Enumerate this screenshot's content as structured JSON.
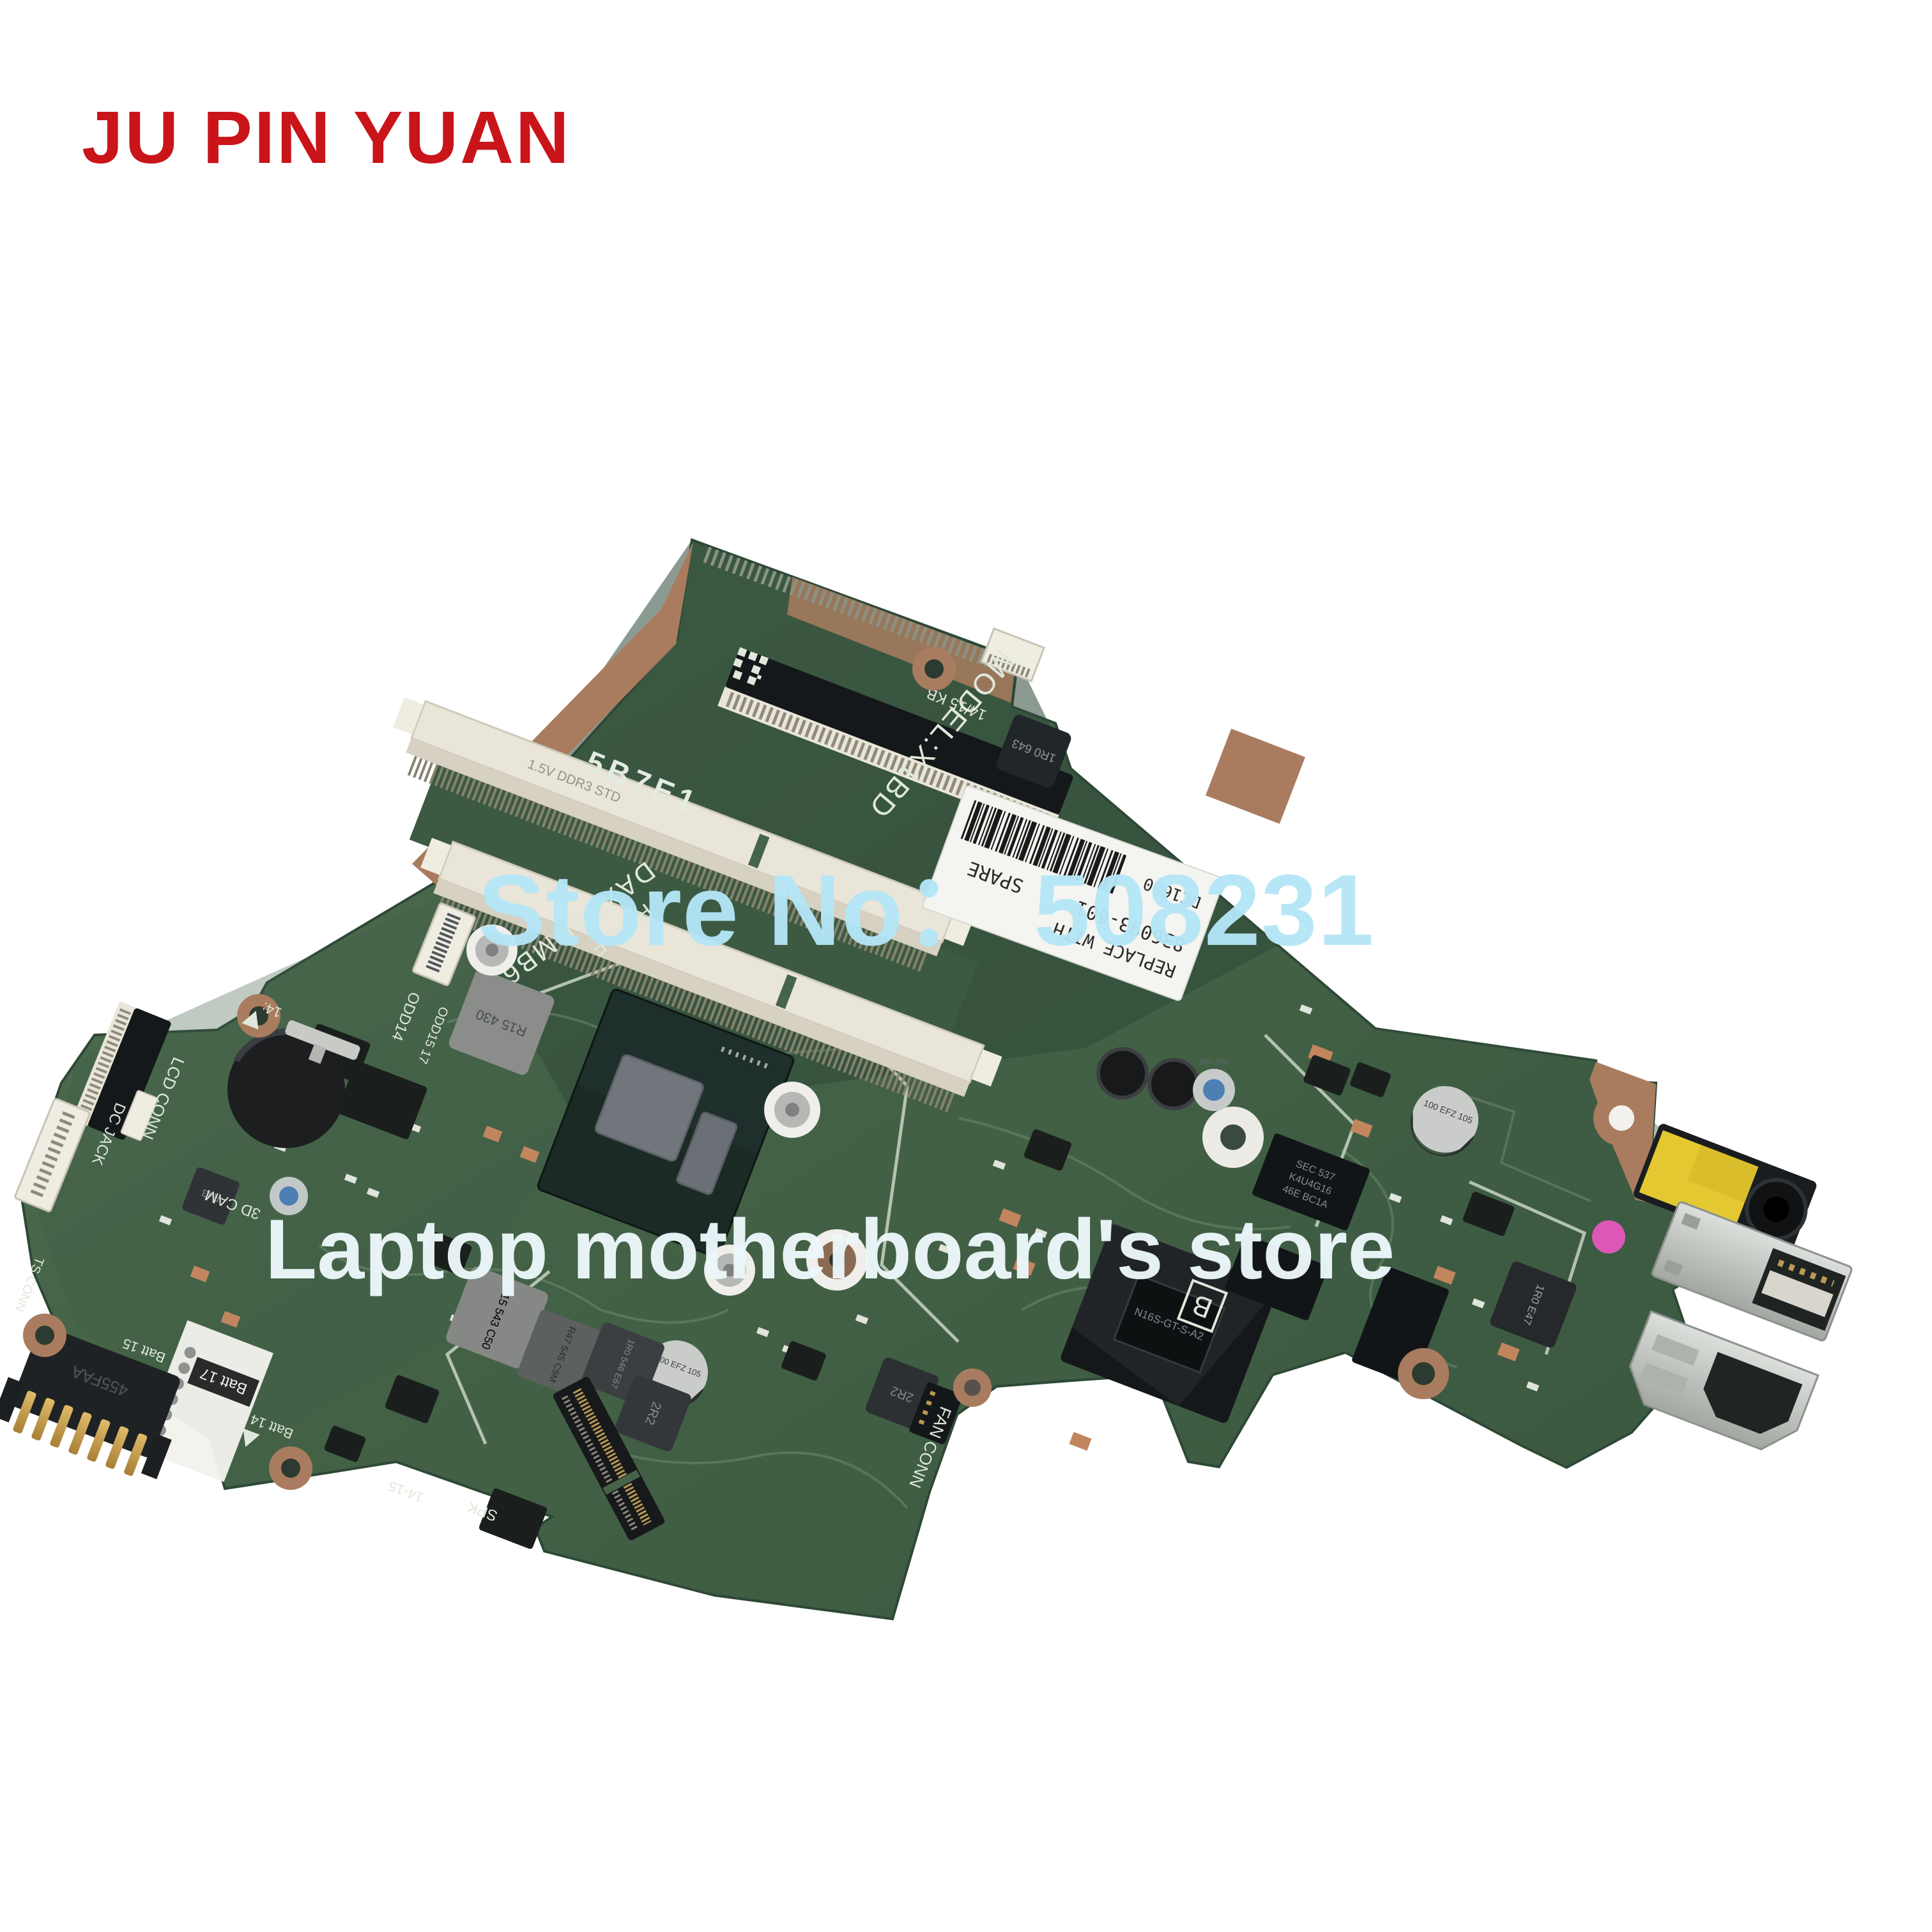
{
  "brand": {
    "name": "JU PIN YUAN",
    "color": "#c9141a"
  },
  "watermarks": {
    "store_no": "Store No： 508231",
    "store_no_color": "#b5e7f7",
    "store_name": "Laptop motherboard's store",
    "store_name_color": "#ecf7fa"
  },
  "board": {
    "model": "MODEL:X1BD",
    "board_number": "DAX1BDMB6E0",
    "revision": "REV:F",
    "stamp": "5B7E1",
    "edge_code": "14/15 KB",
    "position_letter": "L",
    "spare_label": {
      "replace_with": "REPLACE WITH",
      "part_number": "836093-601",
      "spare": "SPARE",
      "date_code": "DC1680"
    },
    "silkscreen": {
      "odd14": "ODD14",
      "odd15": "ODD15 17",
      "lcd_conn": "LCD CONN",
      "dc_jack": "DC JACK",
      "ts_conn": "TS CONN",
      "cam_3d": "3D CAM",
      "batt_15": "Batt 15",
      "batt_17": "Batt 17",
      "batt_14": "Batt 14",
      "fan_conn": "FAN CONN",
      "spk": "SPK",
      "panel_14_15": "14-15",
      "mark_14": "14:",
      "b_mark": "B",
      "ddr_mark": "1.5V DDR3 STD"
    },
    "chips": {
      "gpu": "N16S-GT-S-A2",
      "vram_line1": "SEC 537",
      "vram_line2": "K4U4G16",
      "vram_line3": "46E BC1A",
      "battery_conn": "455FAA",
      "ind_r15_430": "R15 430",
      "ind_r15_543": "R15 543 C50",
      "ind_r47": "R47 545 C9M",
      "ind_1r0_546": "1R0 546 E67",
      "ind_2r2": "2R2",
      "ind_1r0_e47": "1R0 E47",
      "ind_1r0_643": "1R0 643",
      "ind_r43": "R43",
      "cap_100": "100 EFZ 105",
      "cap_390": "390 25V"
    }
  },
  "colors": {
    "pcb_green": "#46644a",
    "pcb_dark": "#35523d",
    "silkscreen": "#dfe8da",
    "copper": "#a97c5f",
    "slot_cream": "#e9e5d9",
    "chip_black": "#191e1c",
    "gold": "#c59a4a",
    "metal": "#c7cac5",
    "label_white": "#f4f4f0",
    "audio_yellow": "#e3c832"
  }
}
